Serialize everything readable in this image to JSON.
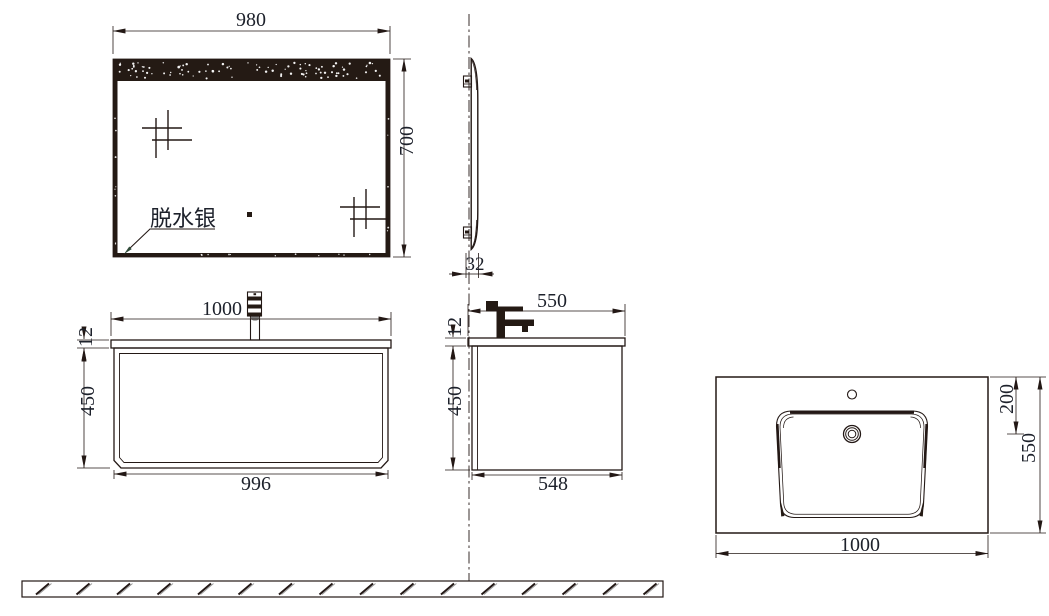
{
  "views": {
    "mirror_front": {
      "width": "980",
      "height": "700",
      "coating_label": "脱水银"
    },
    "mirror_side": {
      "thickness": "32"
    },
    "vanity_front": {
      "counter_width": "1000",
      "counter_thickness": "12",
      "cabinet_height": "450",
      "cabinet_width": "996"
    },
    "vanity_side": {
      "counter_depth": "550",
      "counter_thickness": "12",
      "cabinet_height": "450",
      "cabinet_depth": "548"
    },
    "basin_top": {
      "drain_offset": "200",
      "counter_depth": "550",
      "counter_width": "1000"
    }
  },
  "colors": {
    "line": "#231815",
    "text": "#1d212b",
    "background": "#ffffff",
    "leader_arrow": "#2f4a38"
  }
}
